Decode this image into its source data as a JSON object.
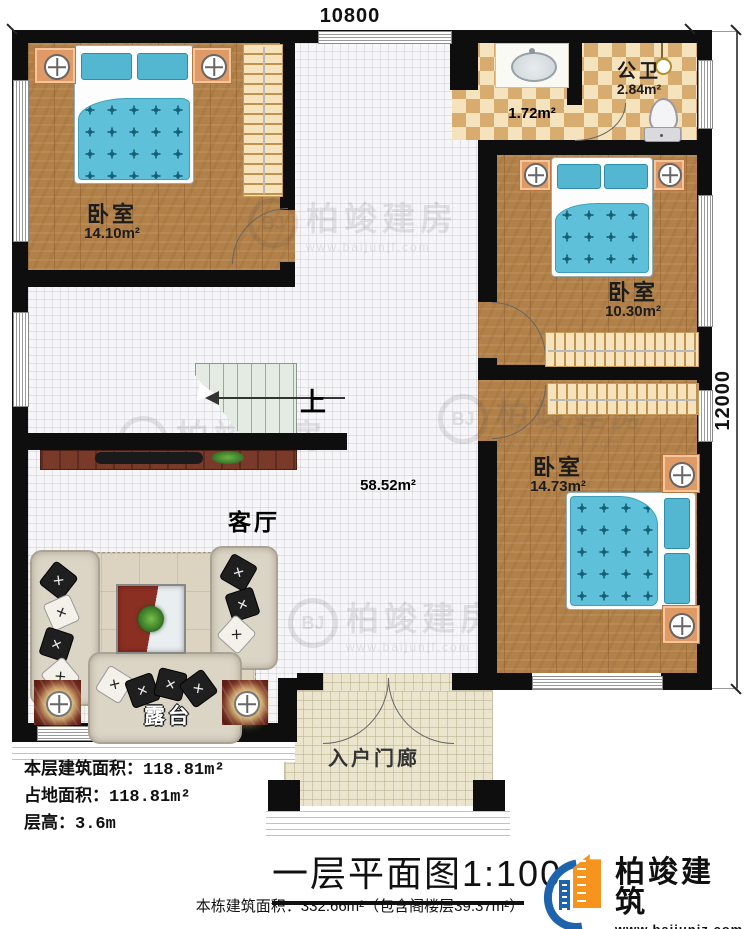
{
  "dimensions": {
    "top": "10800",
    "right": "12000"
  },
  "rooms": {
    "bedroom1": {
      "name": "卧室",
      "area": "14.10m²"
    },
    "bath": {
      "name": "公卫",
      "area": "2.84m²"
    },
    "wash": {
      "area": "1.72m²"
    },
    "bedroom2": {
      "name": "卧室",
      "area": "10.30m²"
    },
    "bedroom3": {
      "name": "卧室",
      "area": "14.73m²"
    },
    "living": {
      "name": "客厅",
      "area": "58.52m²"
    },
    "terrace": {
      "name": "露台"
    },
    "porch": {
      "name": "入户门廊"
    },
    "stairs": {
      "up": "上"
    }
  },
  "info": {
    "floor_area_label": "本层建筑面积：",
    "floor_area_value": "118.81m²",
    "land_area_label": "占地面积：",
    "land_area_value": "118.81m²",
    "story_height_label": "层高：",
    "story_height_value": "3.6m",
    "title": "一层平面图",
    "scale": "1:100",
    "total_area_note": "本栋建筑面积：332.66m²（包含阁楼层39.37m²）"
  },
  "brand": {
    "name": "柏竣建筑",
    "website": "www.baijunjz.com"
  },
  "watermark": {
    "text": "柏竣建房",
    "website": "www.baijunjf.com"
  },
  "colors": {
    "wall": "#0e0e0e",
    "wood": "#b28149",
    "bed": "#5fc0da",
    "brand_blue": "#1d63ae",
    "brand_orange": "#f7941e"
  }
}
